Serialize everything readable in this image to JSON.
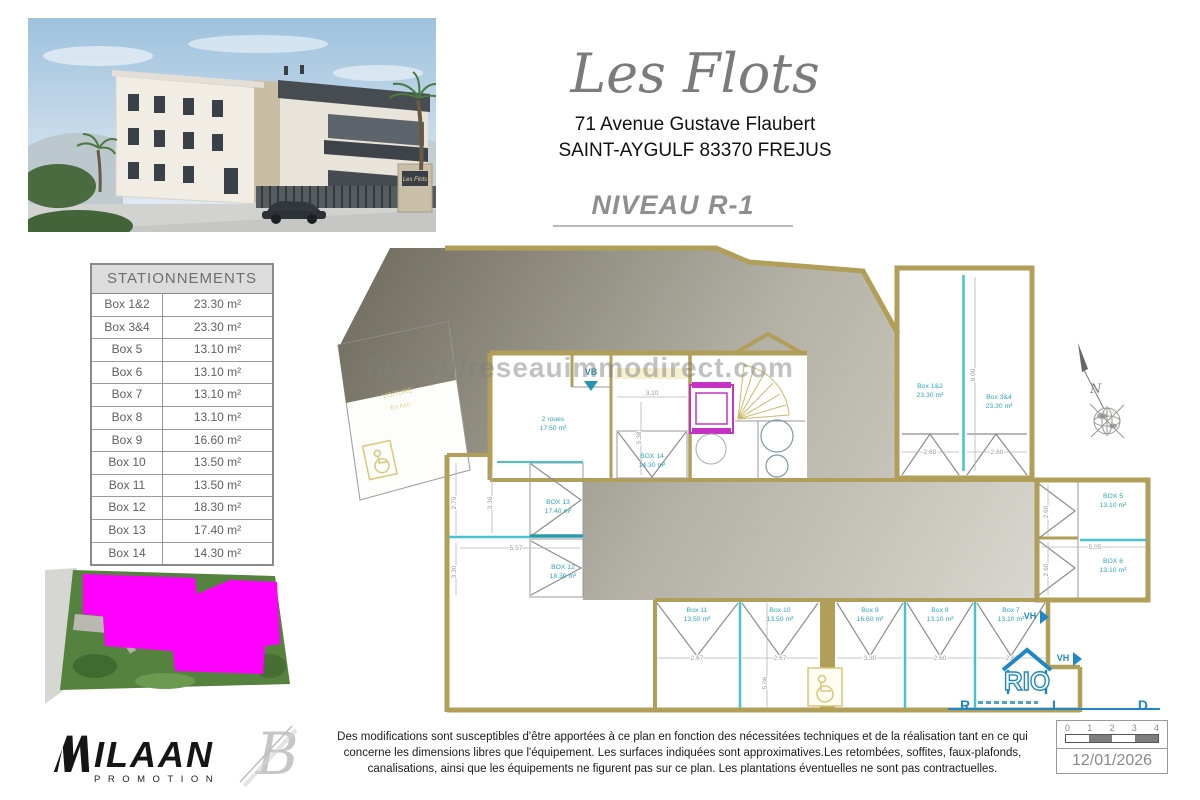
{
  "building_photo": {
    "sign_text": "Les Flots"
  },
  "header": {
    "title": "Les Flots",
    "address_line1": "71 Avenue Gustave Flaubert",
    "address_line2": "SAINT-AYGULF 83370 FREJUS",
    "level": "NIVEAU R-1"
  },
  "watermark": "https://reseauimmodirect.com",
  "parking_table": {
    "title": "STATIONNEMENTS",
    "rows": [
      {
        "label": "Box 1&2",
        "area": "23.30 m²"
      },
      {
        "label": "Box 3&4",
        "area": "23.30 m²"
      },
      {
        "label": "Box 5",
        "area": "13.10 m²"
      },
      {
        "label": "Box 6",
        "area": "13.10 m²"
      },
      {
        "label": "Box 7",
        "area": "13.10 m²"
      },
      {
        "label": "Box 8",
        "area": "13.10 m²"
      },
      {
        "label": "Box 9",
        "area": "16.60 m²"
      },
      {
        "label": "Box 10",
        "area": "13.50 m²"
      },
      {
        "label": "Box 11",
        "area": "13.50 m²"
      },
      {
        "label": "Box 12",
        "area": "18.30 m²"
      },
      {
        "label": "Box 13",
        "area": "17.40 m²"
      },
      {
        "label": "Box 14",
        "area": "14.30 m²"
      }
    ]
  },
  "plan": {
    "rooms": [
      {
        "name": "Box 1&2",
        "area": "23.30 m²"
      },
      {
        "name": "Box 3&4",
        "area": "23.30 m²"
      },
      {
        "name": "BOX 5",
        "area": "13.10 m²"
      },
      {
        "name": "BOX 6",
        "area": "13.10 m²"
      },
      {
        "name": "Box 7",
        "area": "13.10 m²"
      },
      {
        "name": "Box 8",
        "area": "13.10 m²"
      },
      {
        "name": "Box 9",
        "area": "16.60 m²"
      },
      {
        "name": "Box 10",
        "area": "13.50 m²"
      },
      {
        "name": "Box 11",
        "area": "13.50 m²"
      },
      {
        "name": "BOX 12",
        "area": "18.30 m²"
      },
      {
        "name": "BOX 13",
        "area": "17.40 m²"
      },
      {
        "name": "BOX 14",
        "area": "14.30 m²"
      },
      {
        "name": "2 roues",
        "area": "17.50 m²"
      }
    ],
    "dims": {
      "w310": "3.10",
      "h538": "5.38",
      "h900": "9.00",
      "w260a": "2.60",
      "w260b": "2.60",
      "h270": "2.70",
      "h336": "3.36",
      "h330": "3.30",
      "w557": "5.57",
      "w267a": "2.67",
      "w267b": "2.67",
      "w330": "3.30",
      "w260c": "2.60",
      "w262": "2.62",
      "h506": "5.06",
      "w505": "5.05",
      "h260d": "2.60",
      "h260e": "2.60"
    },
    "markers": {
      "vb": "VB",
      "vh1": "VH",
      "vh2": "VH",
      "north": "N"
    },
    "ramp": {
      "line1": "VOITURE",
      "line2": "En Acc"
    }
  },
  "rio": {
    "house": "RIO",
    "r": "R",
    "i": "I",
    "d": "D"
  },
  "footer": {
    "promoter": {
      "name": "ILAAN",
      "sub": "PROMOTION"
    },
    "disclaimer": [
      "Des modifications sont susceptibles d'être apportées à ce plan en fonction des nécessitées techniques et de la réalisation tant en ce qui",
      "concerne les dimensions libres que l'équipement.  Les surfaces indiquées sont approximatives.Les retombées, soffites, faux-plafonds,",
      "canalisations, ainsi que les équipements ne figurent pas sur ce plan. Les plantations éventuelles ne sont pas contractuelles."
    ],
    "scale": {
      "ticks": [
        "0",
        "1",
        "2",
        "3",
        "4"
      ]
    },
    "date": "12/01/2026"
  }
}
